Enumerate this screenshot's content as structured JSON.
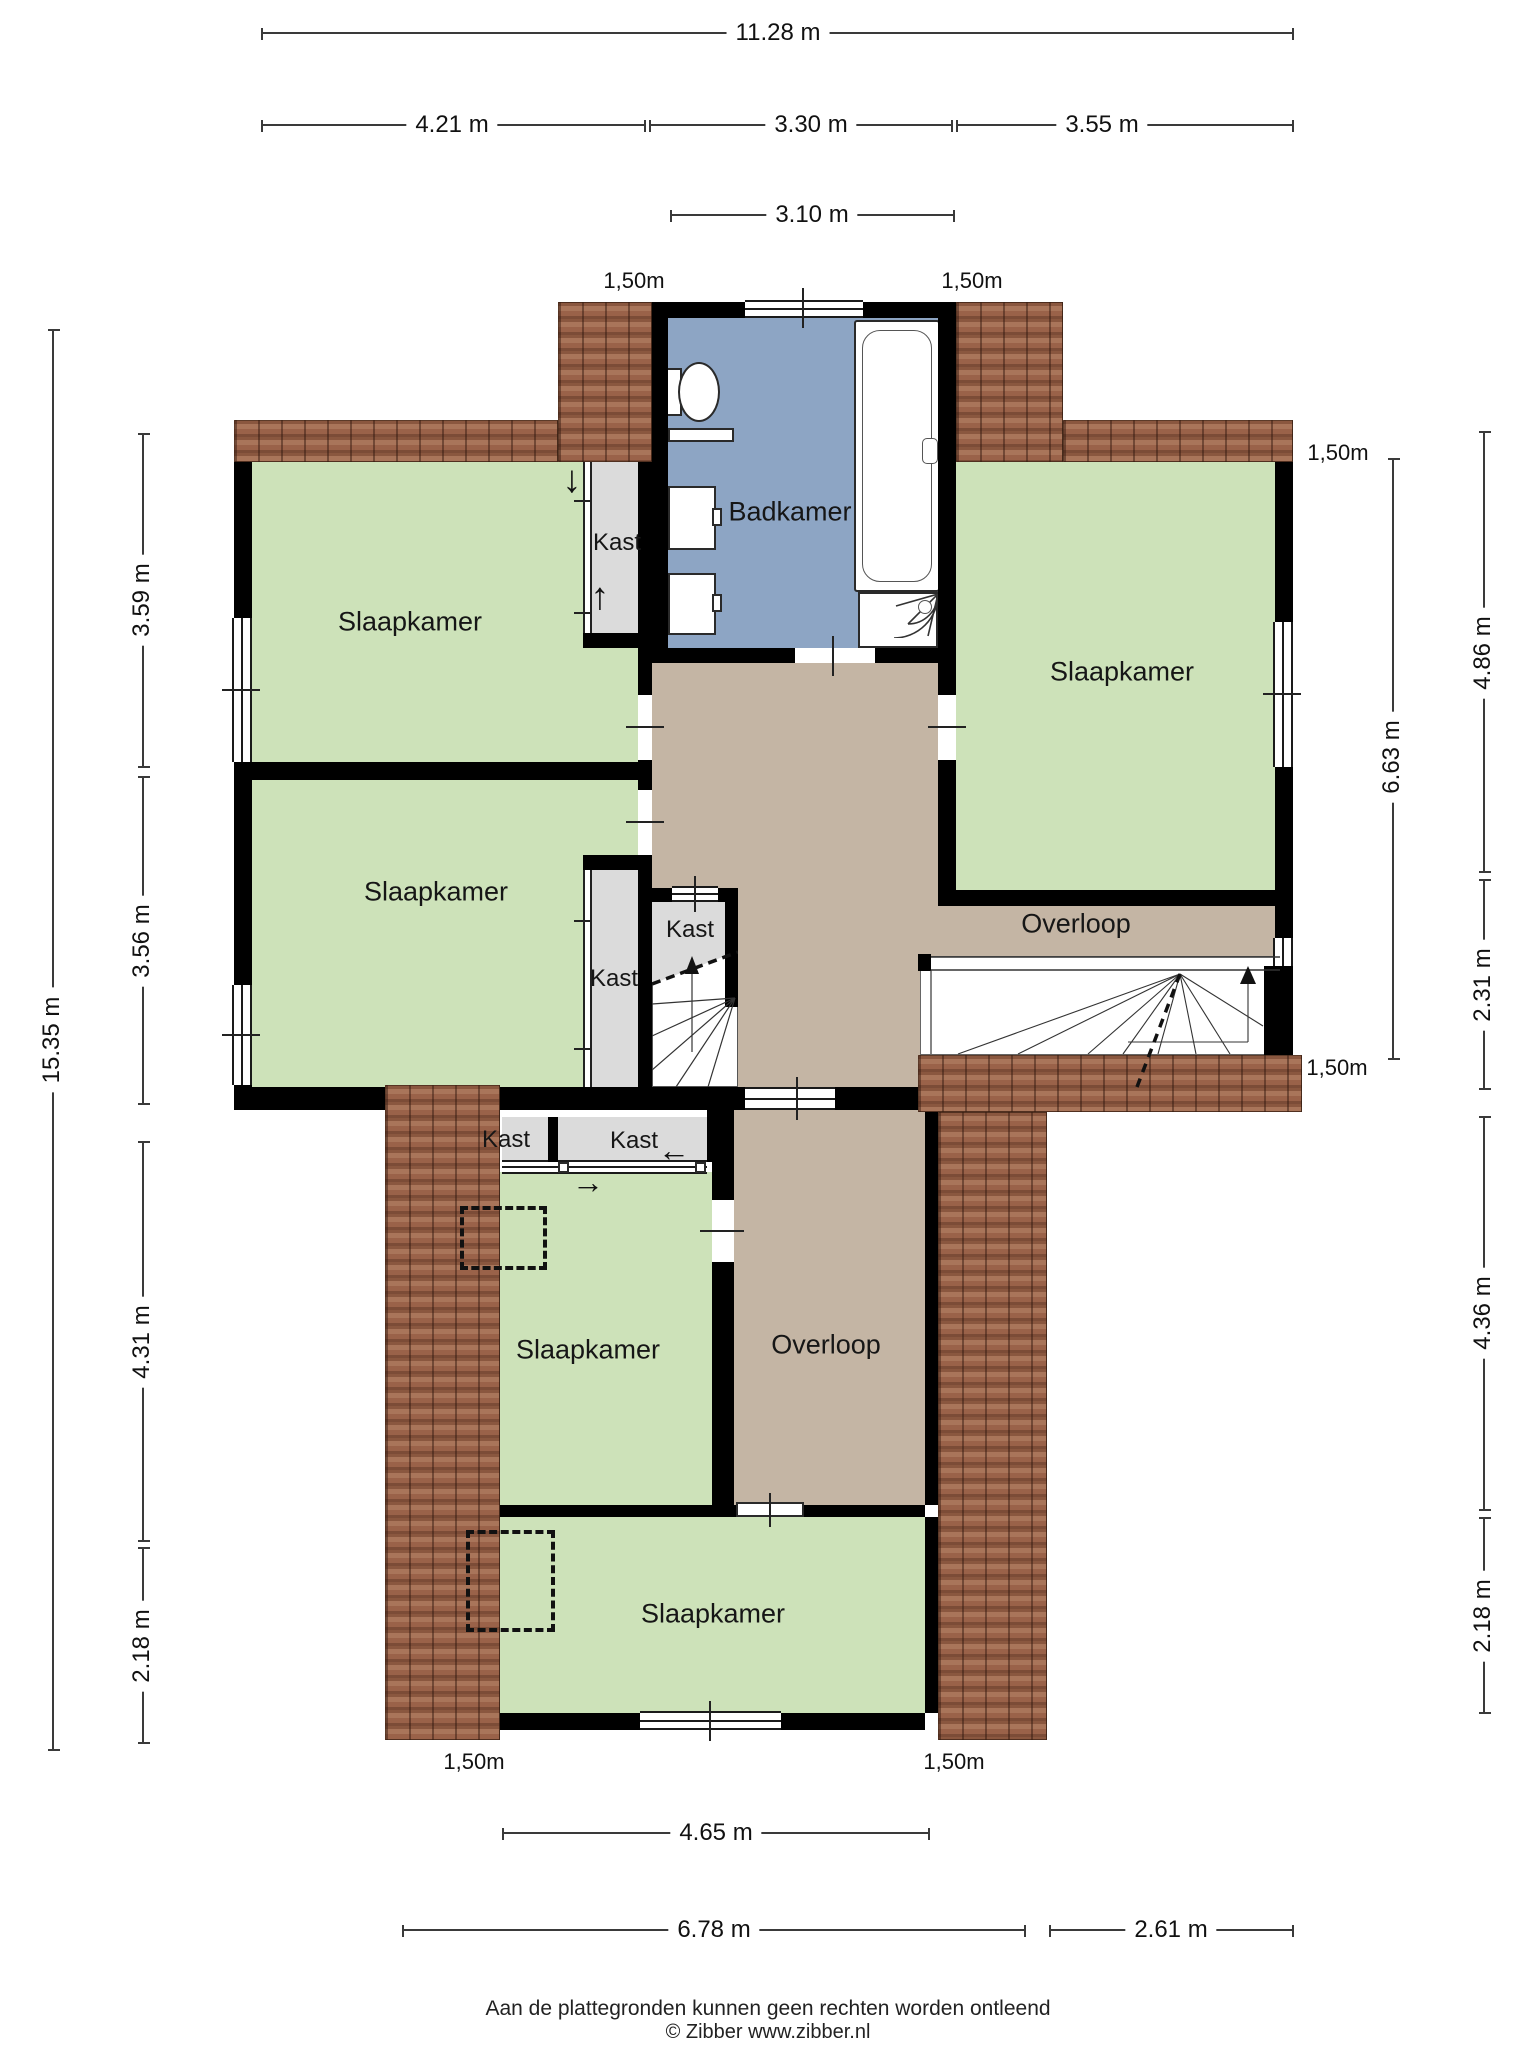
{
  "rooms": {
    "slaapkamer_tl": "Slaapkamer",
    "slaapkamer_ml": "Slaapkamer",
    "slaapkamer_tr": "Slaapkamer",
    "slaapkamer_low": "Slaapkamer",
    "slaapkamer_bottom": "Slaapkamer",
    "badkamer": "Badkamer",
    "overloop_upper": "Overloop",
    "overloop_lower": "Overloop",
    "kast_top": "Kast",
    "kast_tall": "Kast",
    "kast_stair": "Kast",
    "kast_low_left": "Kast",
    "kast_low_right": "Kast"
  },
  "dimensions": {
    "top_total": "11.28 m",
    "top_left": "4.21 m",
    "top_mid": "3.30 m",
    "top_right": "3.55 m",
    "dormer_width": "3.10 m",
    "left_total": "15.35 m",
    "left_1": "3.59 m",
    "left_2": "3.56 m",
    "left_3": "4.31 m",
    "left_4": "2.18 m",
    "right_inner": "6.63 m",
    "right_1": "4.86 m",
    "right_2": "2.31 m",
    "right_3": "4.36 m",
    "right_4": "2.18 m",
    "bottom_inner": "4.65 m",
    "bottom_left": "6.78 m",
    "bottom_right": "2.61 m"
  },
  "height_markers": {
    "top_left": "1,50m",
    "top_right": "1,50m",
    "right_top": "1,50m",
    "right_mid": "1,50m",
    "bottom_left": "1,50m",
    "bottom_right": "1,50m"
  },
  "icons": {
    "arrow_down": "↓",
    "arrow_up": "↑",
    "arrow_left": "←",
    "arrow_right": "→"
  },
  "footer": {
    "disclaimer": "Aan de plattegronden kunnen geen rechten worden ontleend",
    "copyright": "© Zibber www.zibber.nl"
  },
  "colors": {
    "room_green": "#cde2b9",
    "bathroom_blue": "#8da5c4",
    "landing_tan": "#c4b5a4",
    "closet_gray": "#dbdbdb",
    "roof_brown": "#9a6249",
    "wall_black": "#000000"
  }
}
